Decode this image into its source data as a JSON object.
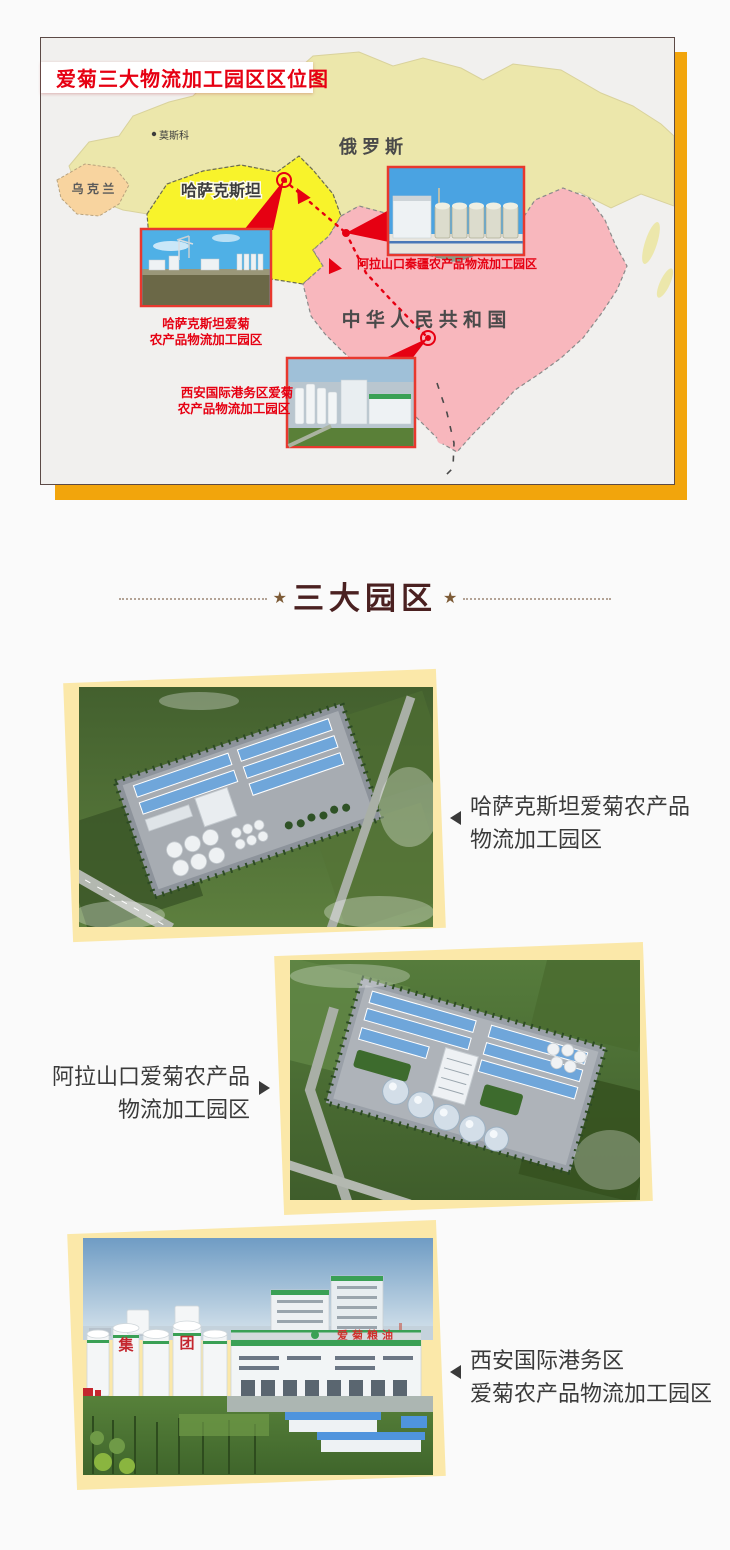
{
  "map": {
    "title": "爱菊三大物流加工园区区位图",
    "countries": {
      "russia": "俄  罗  斯",
      "ukraine": "乌 克 兰",
      "kazakhstan": "哈萨克斯坦",
      "china": "中 华 人 民 共 和 国"
    },
    "cities": {
      "moscow": "莫斯科"
    },
    "park_labels": {
      "alashankou": "阿拉山口秦疆农产品物流加工园区",
      "kazakhstan_line1": "哈萨克斯坦爱菊",
      "kazakhstan_line2": "农产品物流加工园区",
      "xian_line1": "西安国际港务区爱菊",
      "xian_line2": "农产品物流加工园区"
    }
  },
  "section": {
    "star": "★",
    "title": "三大园区"
  },
  "parks": [
    {
      "line1": "哈萨克斯坦爱菊农产品",
      "line2": "物流加工园区"
    },
    {
      "line1": "阿拉山口爱菊农产品",
      "line2": "物流加工园区"
    },
    {
      "line1": "西安国际港务区",
      "line2": "爱菊农产品物流加工园区"
    }
  ],
  "photo_texts": {
    "xian_roof": "爱菊粮油",
    "tank_left": "集",
    "tank_right": "团"
  },
  "colors": {
    "accent_orange": "#F2A50C",
    "shadow_yellow": "#FBE8A9",
    "map_red": "#E60012",
    "title_brown": "#4A2020"
  }
}
